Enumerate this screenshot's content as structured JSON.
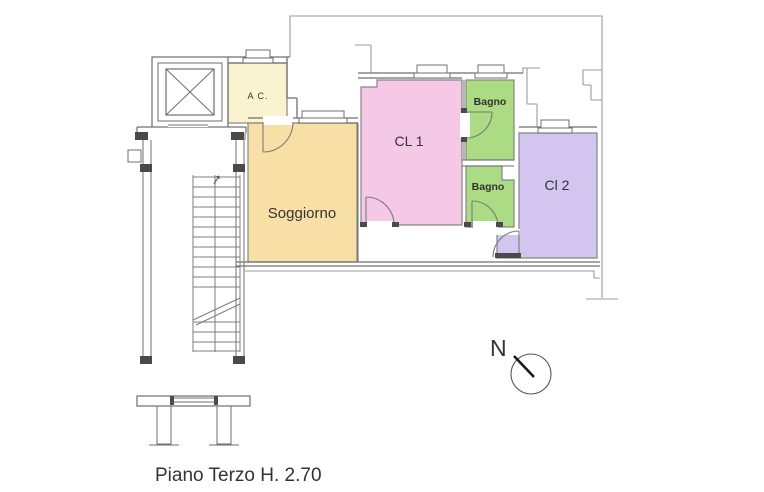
{
  "plan": {
    "caption": "Piano Terzo H. 2.70",
    "compass": {
      "label": "N"
    },
    "rooms": [
      {
        "id": "ac",
        "label": "A C.",
        "color": "#faf3cf"
      },
      {
        "id": "soggiorno",
        "label": "Soggiorno",
        "color": "#f8dfa6"
      },
      {
        "id": "cl1",
        "label": "CL 1",
        "color": "#f5c8e6"
      },
      {
        "id": "bagno1",
        "label": "Bagno",
        "color": "#abdb82"
      },
      {
        "id": "bagno2",
        "label": "Bagno",
        "color": "#abdb82"
      },
      {
        "id": "cl2",
        "label": "Cl 2",
        "color": "#d2c5ef"
      }
    ],
    "colors": {
      "wall": "#6f6f6f",
      "thin_line": "#9a9a9a",
      "room_border": "#858585",
      "dark_mark": "#4a4a4a",
      "text": "#333333",
      "background": "#ffffff"
    }
  }
}
